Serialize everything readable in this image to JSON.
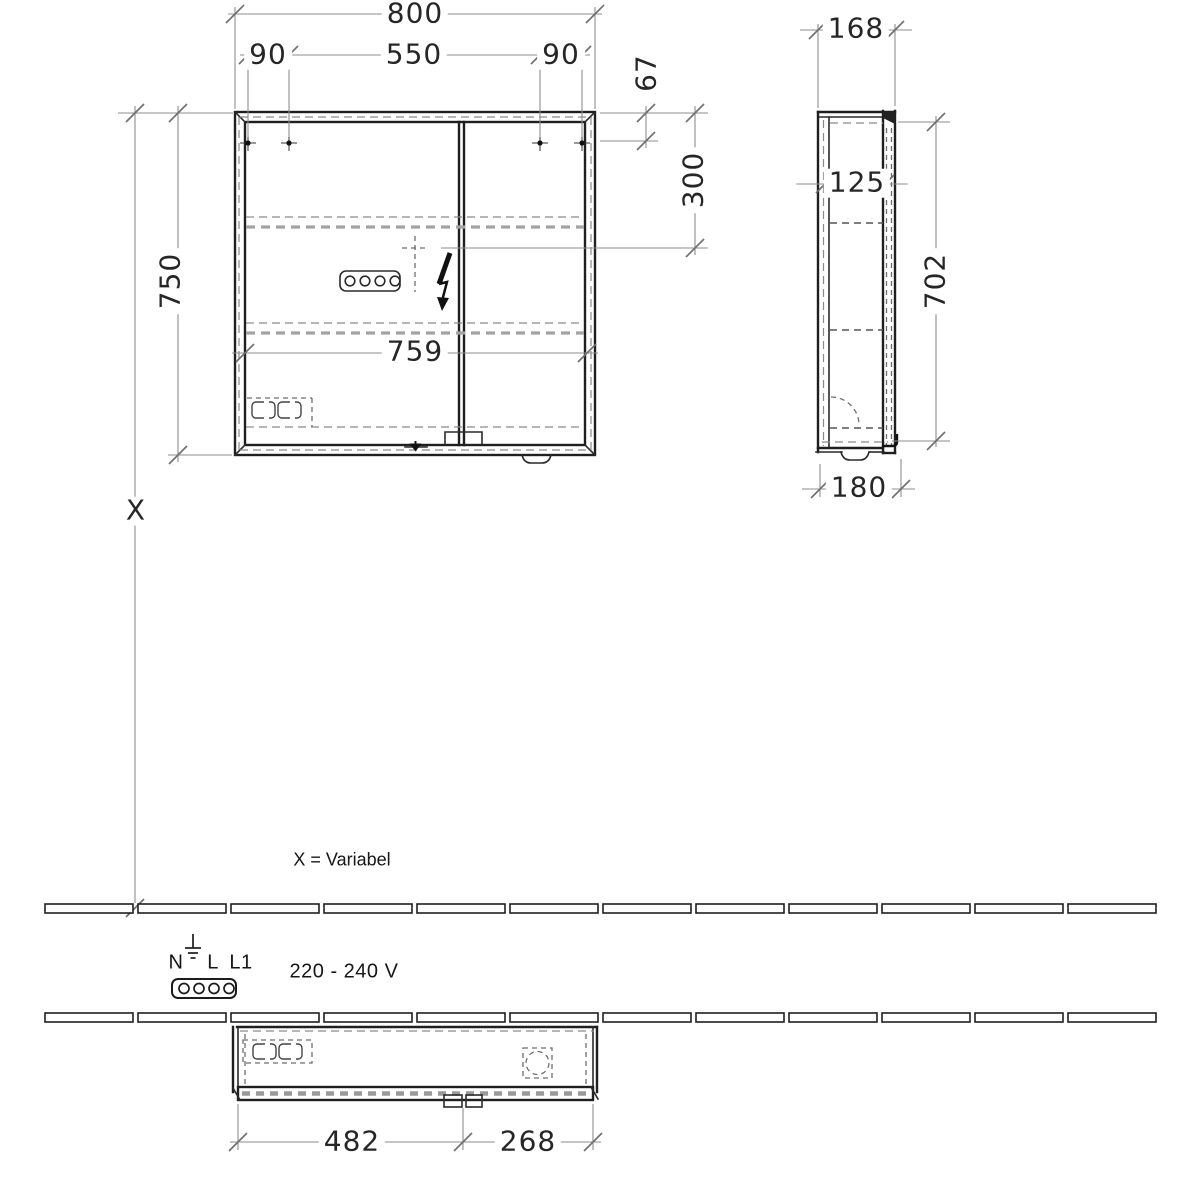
{
  "front_view": {
    "overall_width": "800",
    "hole_offset_left": "90",
    "hole_spacing": "550",
    "hole_offset_right": "90",
    "top_to_holes": "67",
    "top_to_outlet_center": "300",
    "height": "750",
    "inner_width": "759",
    "mounting_height_symbol": "X"
  },
  "side_view": {
    "depth": "168",
    "body_depth": "125",
    "inner_height": "702",
    "depth_overall": "180"
  },
  "bottom_view": {
    "left_section_width": "482",
    "right_section_width": "268"
  },
  "annotations": {
    "variable_note": "X = Variabel",
    "voltage": "220 - 240 V",
    "terminal_n": "N",
    "terminal_l": "L",
    "terminal_l1": "L1"
  }
}
